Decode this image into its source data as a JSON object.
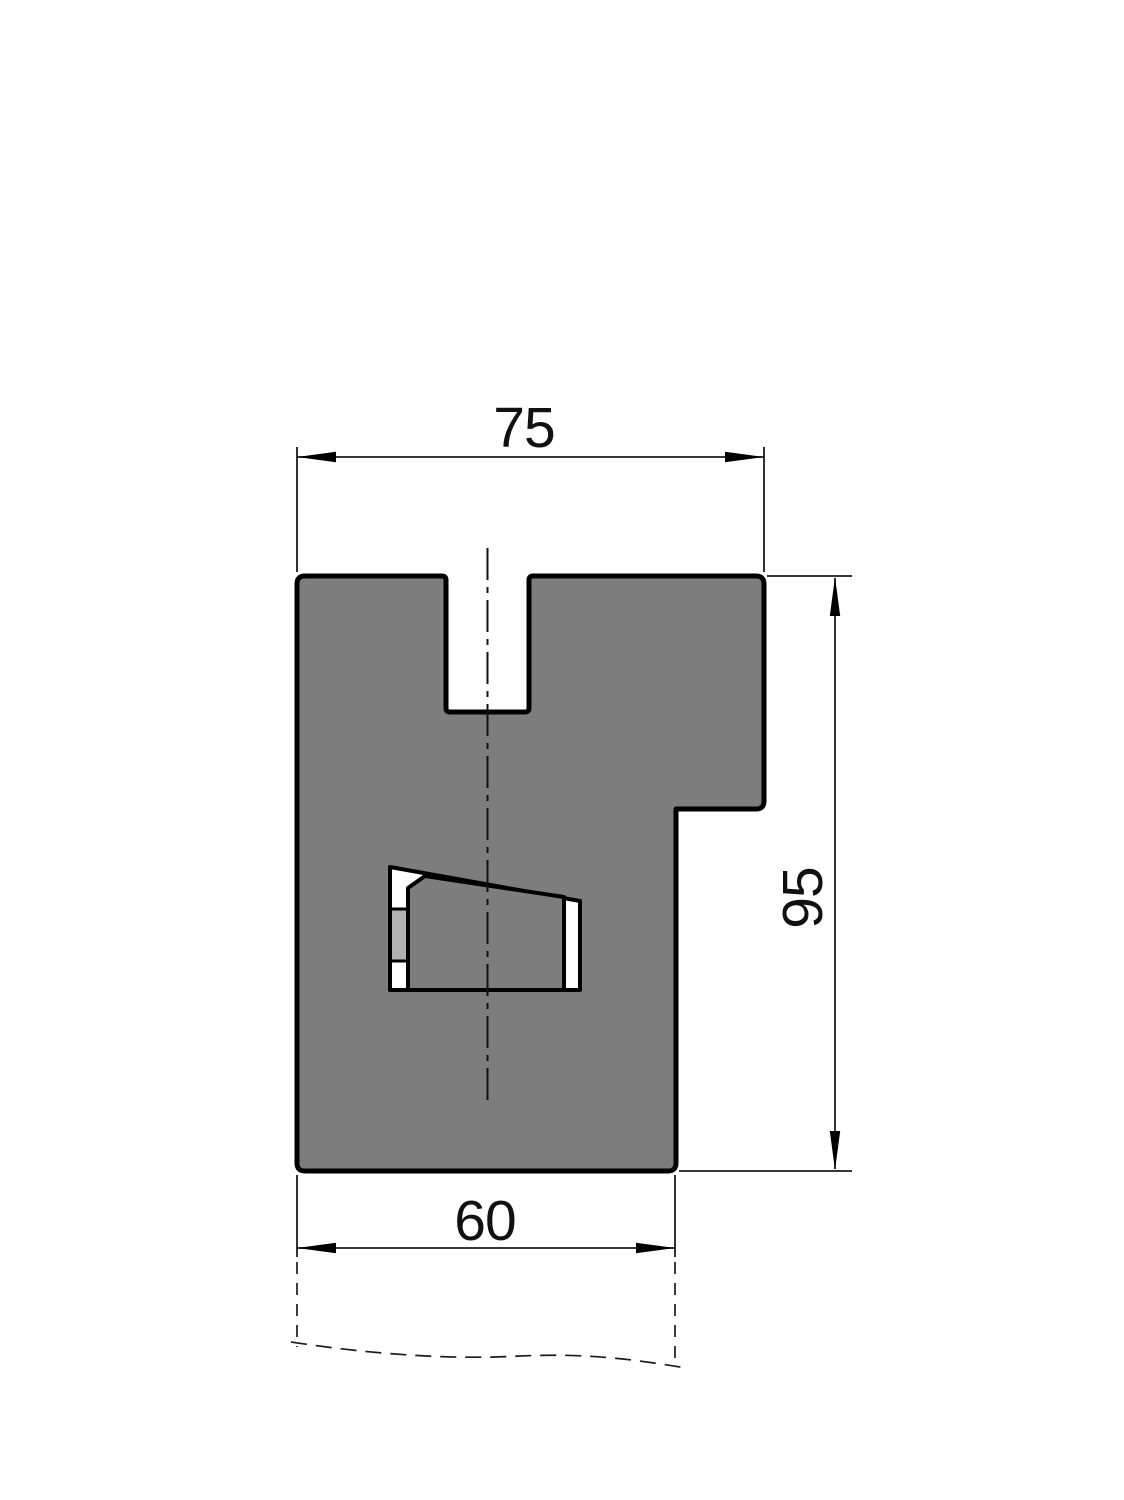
{
  "drawing": {
    "kind": "technical-cross-section-drawing",
    "dimensions": {
      "top_width": "75",
      "right_height": "95",
      "bottom_width": "60"
    },
    "colors": {
      "body_fill": "#7d7d7d",
      "insert_fill": "#b2b2b2",
      "window_fill": "#ffffff",
      "outline": "#000000",
      "thin_line": "#1c1c1c",
      "background": "#ffffff"
    }
  }
}
